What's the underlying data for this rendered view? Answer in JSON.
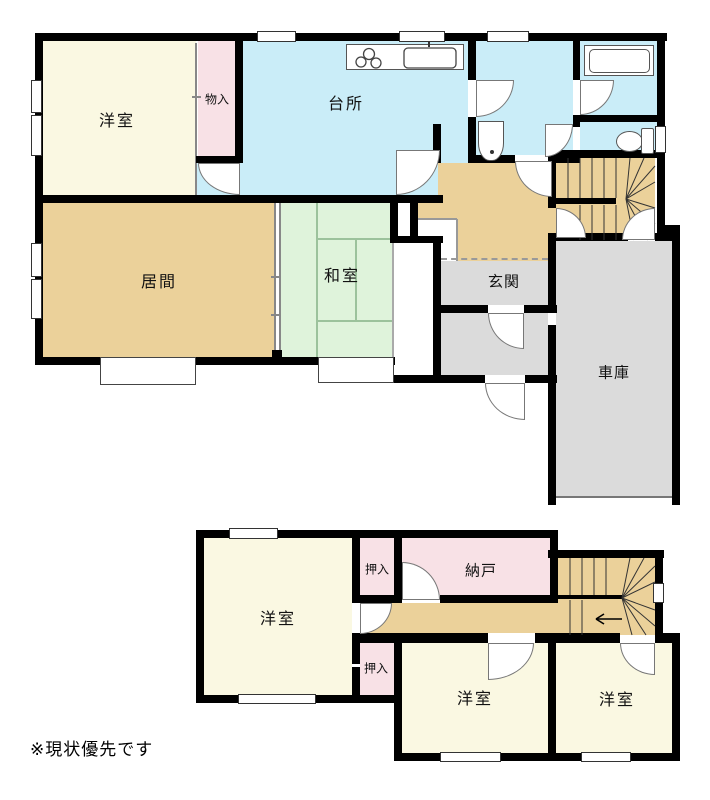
{
  "title": "two-story-floor-plan",
  "floors": {
    "first": {
      "rooms": {
        "western_room": "洋室",
        "storage": "物入",
        "kitchen": "台所",
        "living_room": "居間",
        "japanese_room": "和室",
        "entrance": "玄関",
        "garage": "車庫"
      }
    },
    "second": {
      "rooms": {
        "western_room_1": "洋室",
        "closet_upper": "押入",
        "storeroom": "納戸",
        "closet_lower": "押入",
        "western_room_2": "洋室",
        "western_room_3": "洋室"
      }
    }
  },
  "note": "※現状優先です",
  "stairs": {
    "first_floor": "u-turn-winder",
    "second_floor_arrow_direction": "left"
  },
  "icons": [
    "stove-icon",
    "sink-icon",
    "washbasin-icon",
    "bathtub-icon",
    "toilet-icon",
    "stair-arrow-icon"
  ],
  "colors": {
    "wall": "#000000",
    "cream": "#FAF8E2",
    "pink": "#F8E1E6",
    "blue": "#CAEDF8",
    "tan": "#EBD19A",
    "tatami": "#DFF3DB",
    "tatami_line": "#9CC29C",
    "gray": "#DBDBDB",
    "line": "#888888"
  }
}
